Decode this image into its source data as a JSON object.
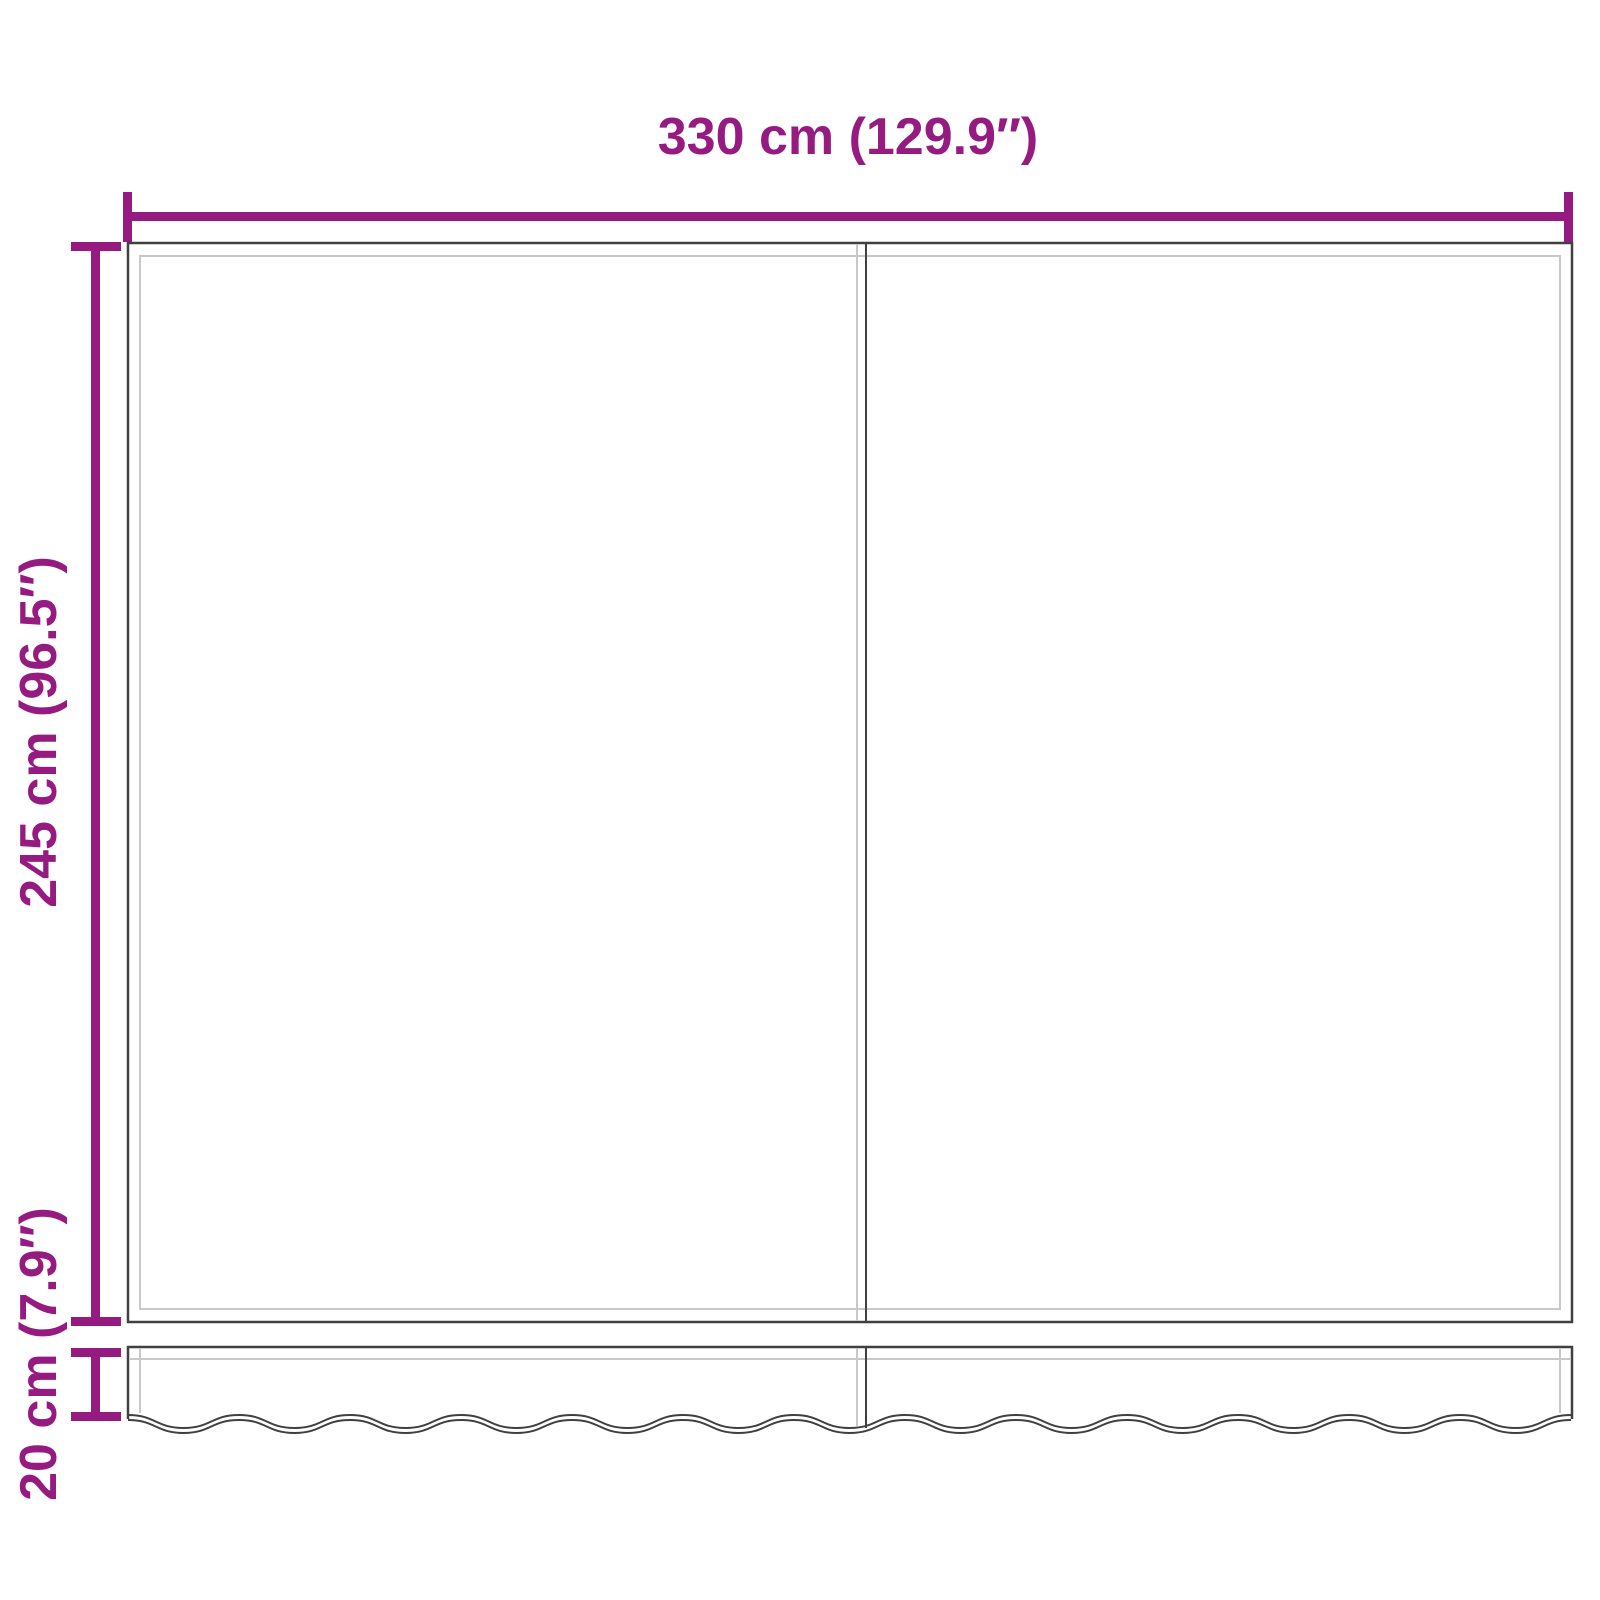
{
  "diagram": {
    "width_dimension": {
      "label": "330 cm (129.9″)"
    },
    "height_dimension": {
      "label": "245 cm (96.5″)"
    },
    "valance_dimension": {
      "label": "20 cm (7.9″)"
    }
  },
  "colors": {
    "dimension": "#951b81",
    "outline_dark": "#404040",
    "outline_light": "#c8c8c8",
    "background": "#ffffff"
  }
}
